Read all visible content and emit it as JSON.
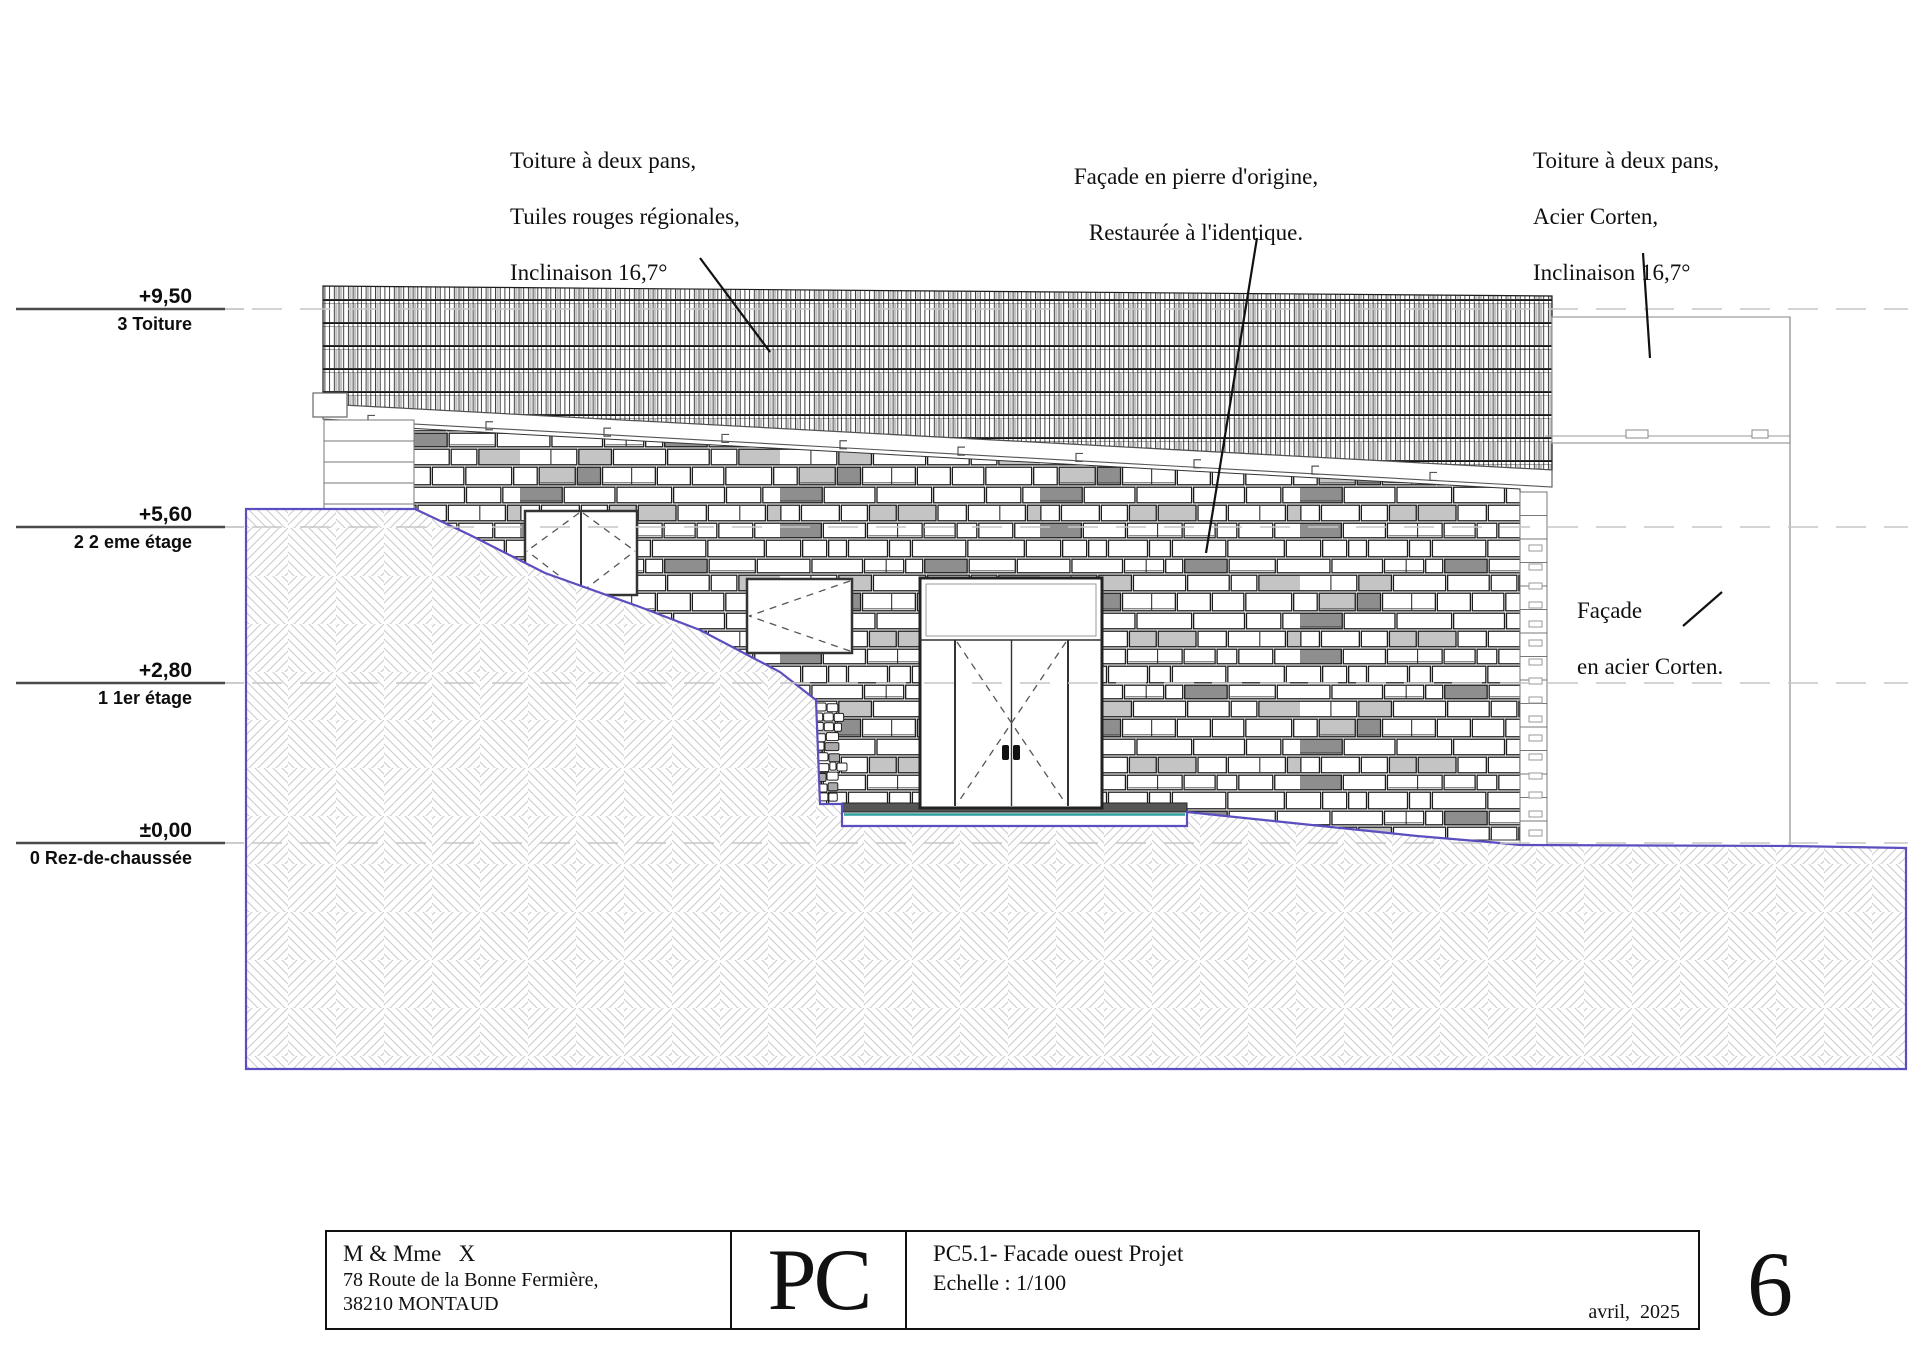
{
  "levels": [
    {
      "value": "+9,50",
      "label": "3 Toiture"
    },
    {
      "value": "+5,60",
      "label": "2 2 eme étage"
    },
    {
      "value": "+2,80",
      "label": "1 1er étage"
    },
    {
      "value": "±0,00",
      "label": "0 Rez-de-chaussée"
    }
  ],
  "annotations": {
    "roof_left": {
      "line1": "Toiture à deux pans,",
      "line2": "Tuiles rouges régionales,",
      "line3": "Inclinaison 16,7°"
    },
    "facade_stone": {
      "line1": "Façade en pierre d'origine,",
      "line2": "Restaurée à l'identique."
    },
    "roof_right": {
      "line1": "Toiture à deux pans,",
      "line2": "Acier Corten,",
      "line3": "Inclinaison 16,7°"
    },
    "facade_corten": {
      "line1": "Façade",
      "line2": "en acier Corten."
    }
  },
  "title_block": {
    "client_name": "M & Mme   X",
    "client_address1": "78 Route de la Bonne Fermière,",
    "client_address2": "38210 MONTAUD",
    "logo": "PC",
    "sheet_title": "PC5.1- Facade ouest Projet",
    "scale": "Echelle : 1/100",
    "date": "avril,  2025",
    "page_number": "6"
  },
  "colors": {
    "terrain_outline": "#5b4fc0",
    "sill_teal": "#2f9e9e",
    "level_line": "#4a4a4a",
    "dashed_level": "#c6c6c6",
    "ink": "#1c1c1c"
  }
}
